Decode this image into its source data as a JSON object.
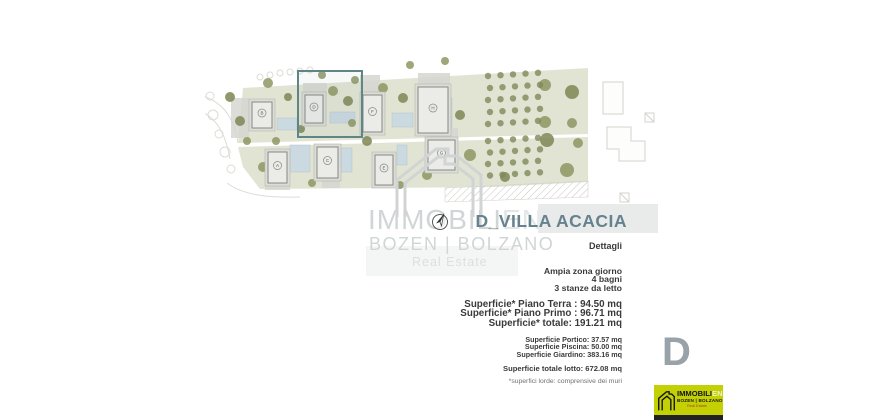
{
  "title": "D_VILLA ACACIA",
  "watermark": {
    "brand_main": "IMMOBILI",
    "brand_suffix": "EN",
    "city": "BOZEN | BOLZANO",
    "tagline": "Real Estate"
  },
  "details": {
    "heading": "Dettagli",
    "features": [
      "Ampia zona giorno",
      "4 bagni",
      "3 stanze da letto"
    ],
    "main_surfaces": [
      "Superficie* Piano Terra : 94.50 mq",
      "Superficie* Piano Primo : 96.71 mq",
      "Superficie* totale: 191.21 mq"
    ],
    "secondary_surfaces": [
      "Superficie Portico: 37.57 mq",
      "Superficie Piscina: 50.00 mq",
      "Superficie Giardino: 383.16 mq"
    ],
    "total_lot": "Superficie totale lotto: 672.08 mq",
    "footnote": "*superfici lorde: comprensive dei muri"
  },
  "unit_letter": "D",
  "site_plan": {
    "highlighted_unit": "D",
    "buildings": [
      {
        "label": "B"
      },
      {
        "label": "D"
      },
      {
        "label": "F"
      },
      {
        "label": "H"
      },
      {
        "label": "A"
      },
      {
        "label": "C"
      },
      {
        "label": "E"
      },
      {
        "label": "G"
      }
    ]
  },
  "logo": {
    "brand_main": "IMMOBILI",
    "brand_suffix": "EN",
    "city": "BOZEN | BOLZANO",
    "tagline": "Real Estate"
  },
  "colors": {
    "highlight_teal": "#5d8684",
    "title_slate": "#65828e",
    "logo_yellow": "#c3d104",
    "plan_green": "#e1e4d3",
    "pool_blue": "#cbd9e1",
    "tree_olive": "#848d5c",
    "watermark_gray": "#d0d5d5",
    "unit_letter_gray": "#99a2a8"
  }
}
